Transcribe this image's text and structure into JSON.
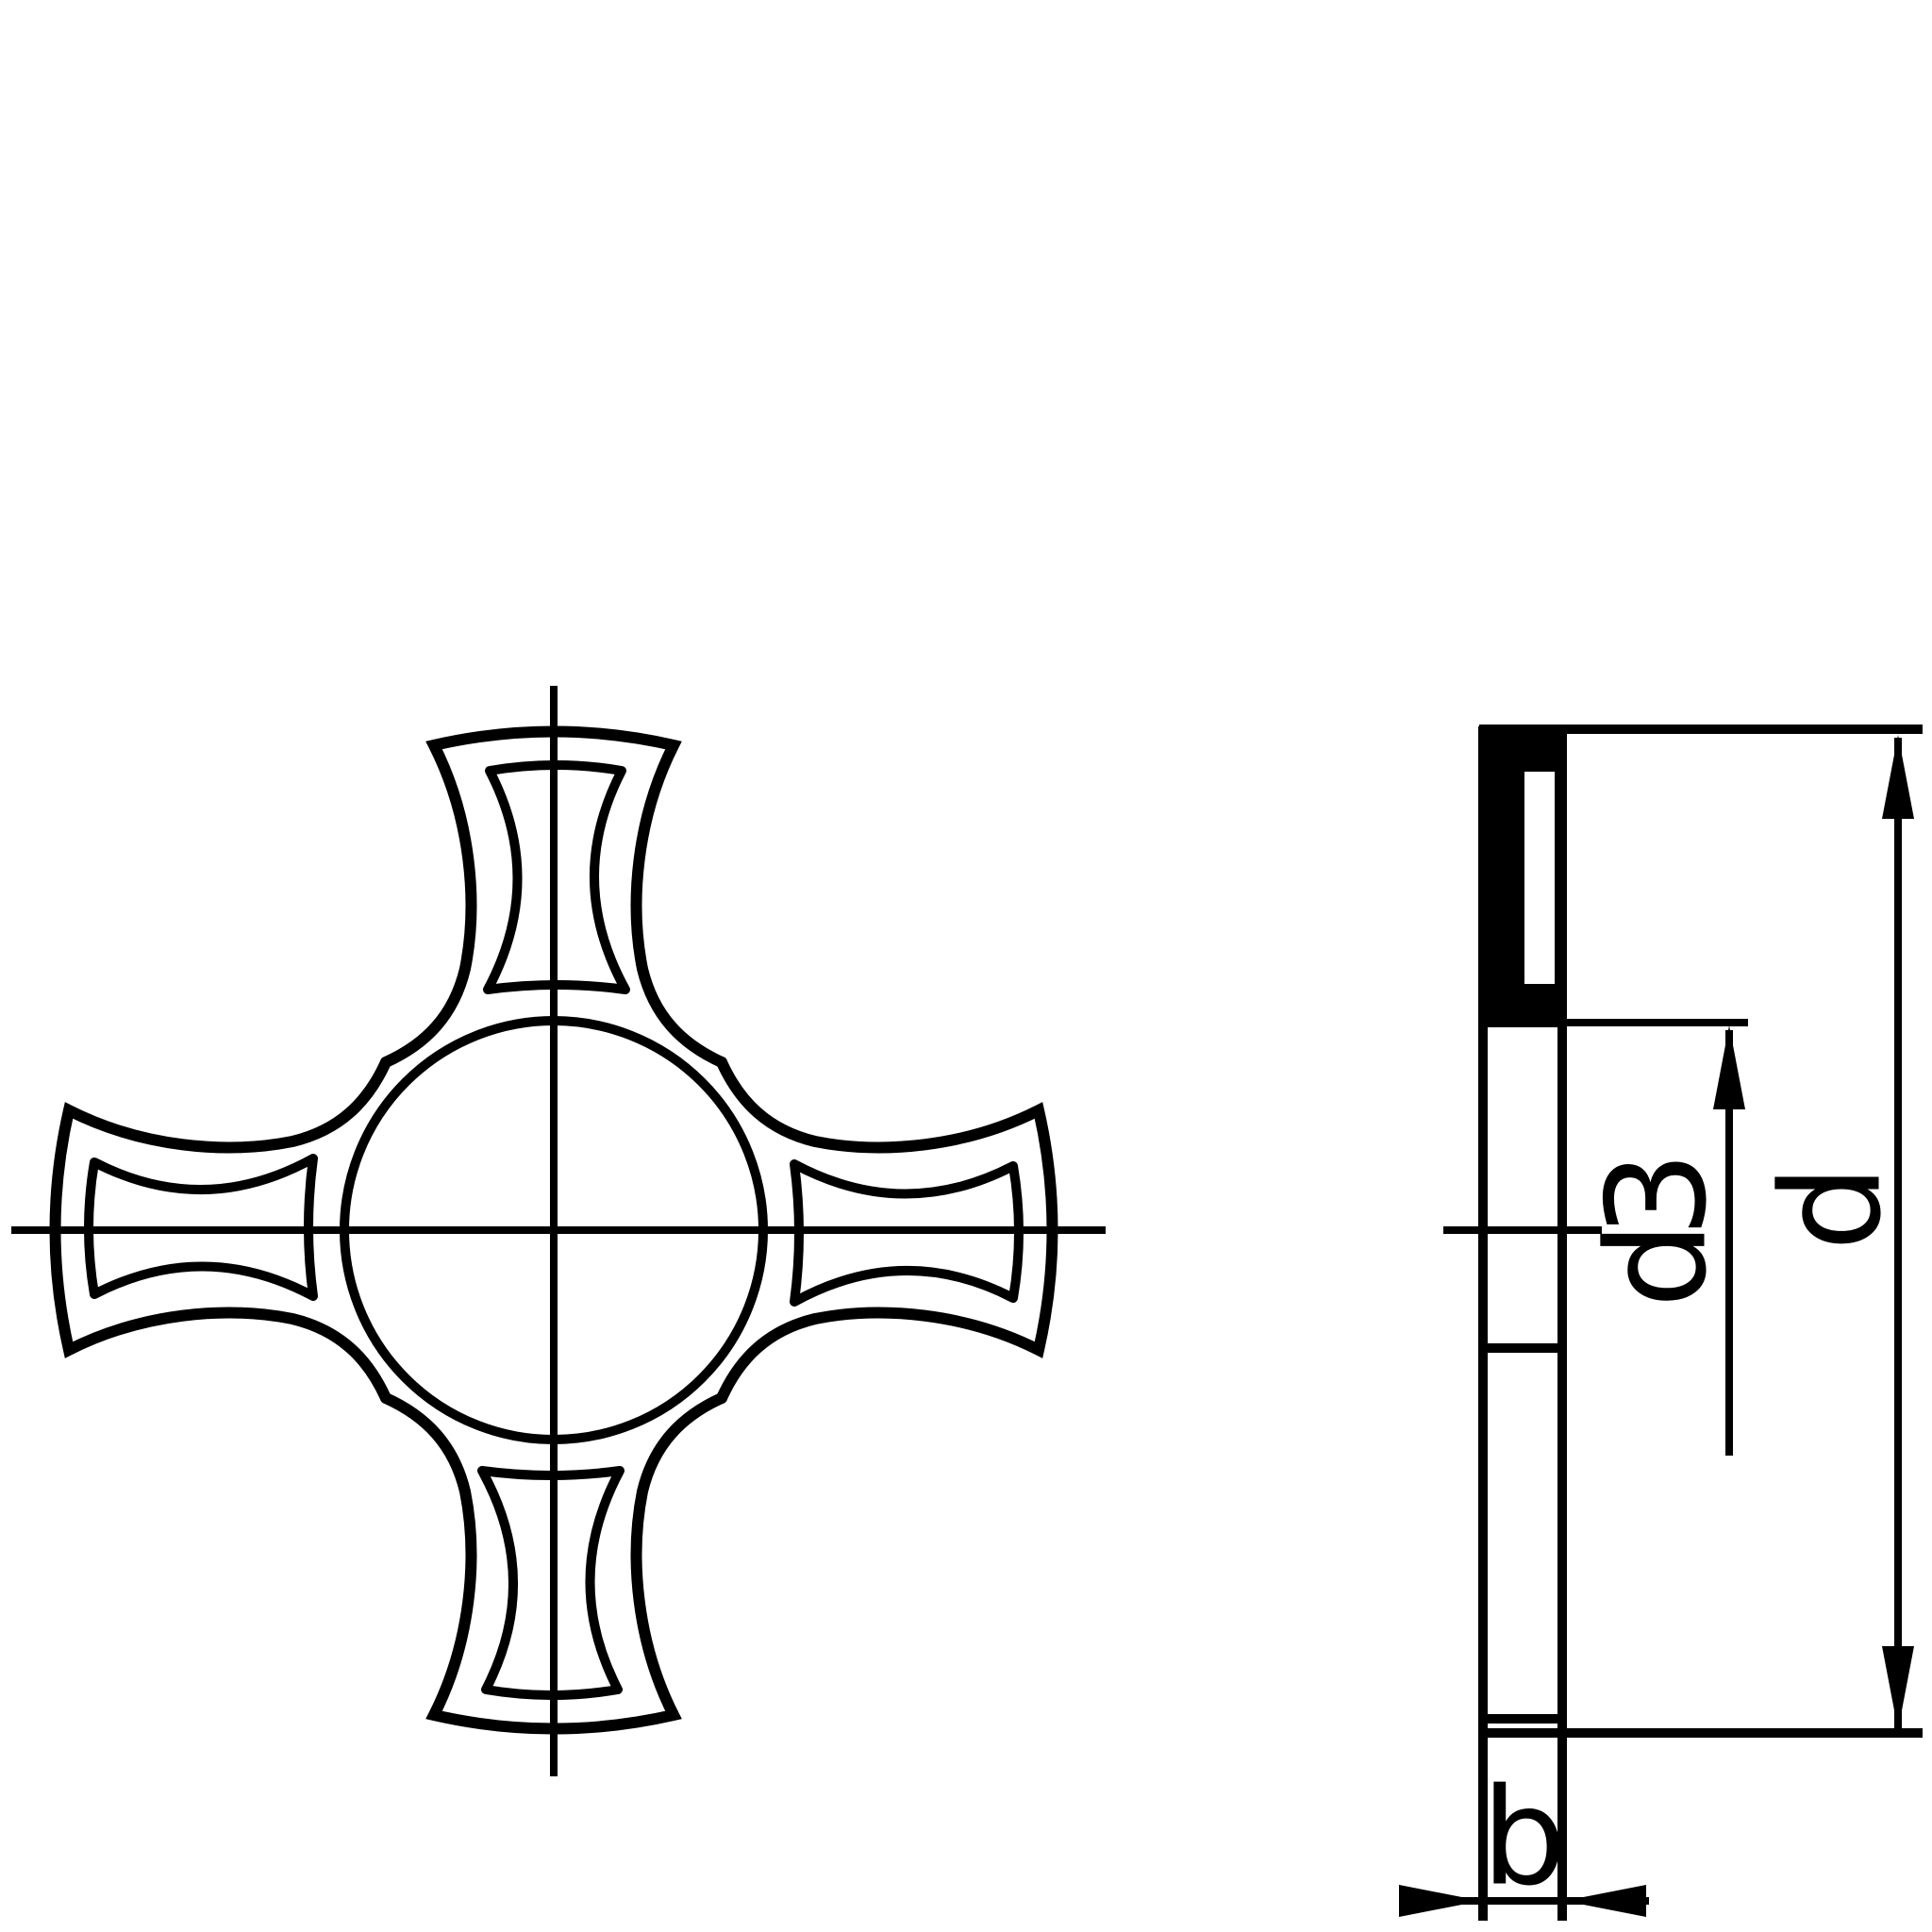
{
  "drawing": {
    "type": "engineering-drawing",
    "description": "two-view technical drawing of a four-tab cross lock washer",
    "colors": {
      "line": "#000000",
      "background": "#ffffff",
      "section_fill": "#000000"
    },
    "views": {
      "front_view": {
        "name": "front view",
        "features": [
          "center hole circle",
          "four concave arms",
          "four pressed recess outlines",
          "crosshair centerlines"
        ]
      },
      "side_view": {
        "name": "side section view",
        "features": [
          "solid black section area",
          "recess slot",
          "centerline",
          "dimension lines"
        ]
      }
    },
    "dimensions": {
      "inner_diameter_label": "d3",
      "outer_diameter_label": "d",
      "thickness_label": "b"
    }
  }
}
